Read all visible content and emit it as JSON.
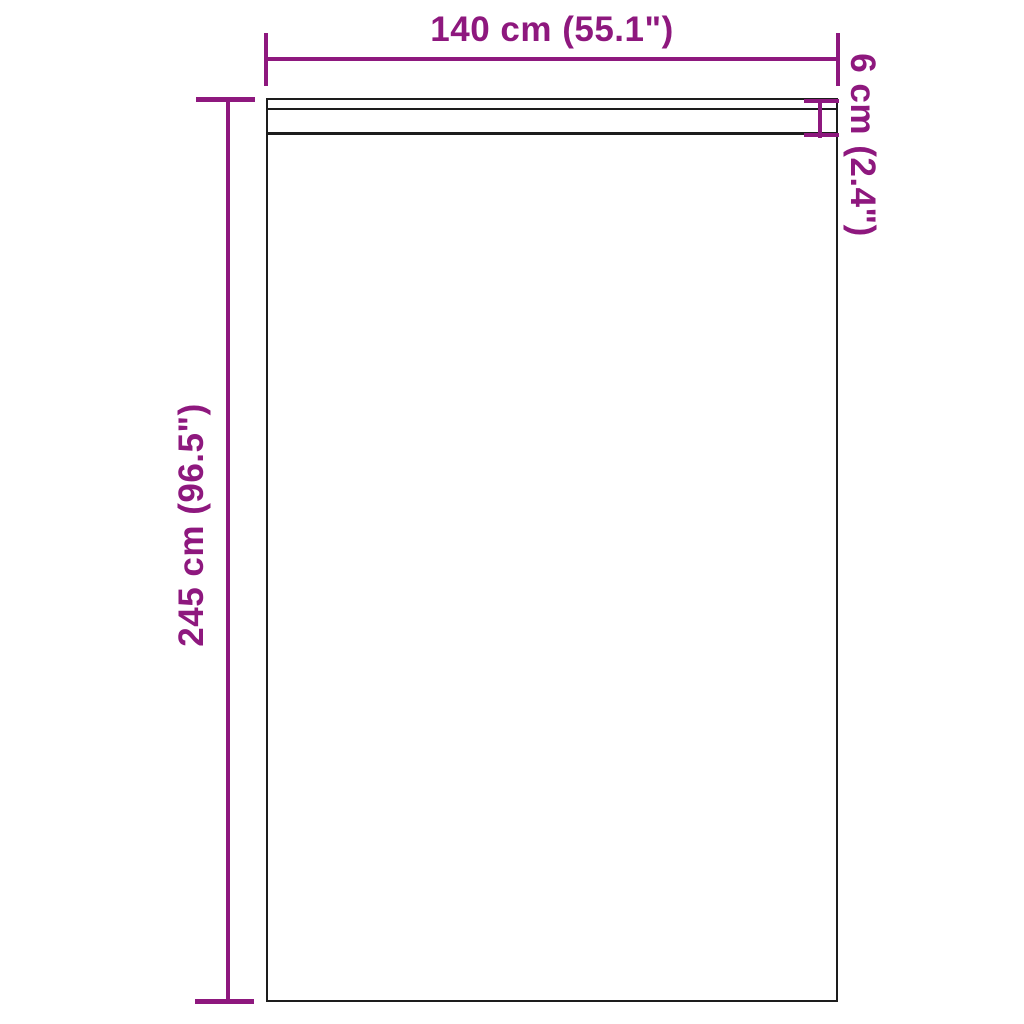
{
  "diagram": {
    "type": "product-dimension-drawing",
    "subject": "curtain panel with rod pocket header",
    "colors": {
      "background": "#ffffff",
      "accent": "#8e187e",
      "outline": "#1d1d1d"
    },
    "dimensions": {
      "width": {
        "label": "140 cm (55.1\")",
        "value_cm": 140,
        "value_in": 55.1,
        "position": "top"
      },
      "height": {
        "label": "245 cm (96.5\")",
        "value_cm": 245,
        "value_in": 96.5,
        "position": "left"
      },
      "pocket": {
        "label": "6 cm (2.4\")",
        "value_cm": 6,
        "value_in": 2.4,
        "position": "right-top"
      }
    }
  }
}
